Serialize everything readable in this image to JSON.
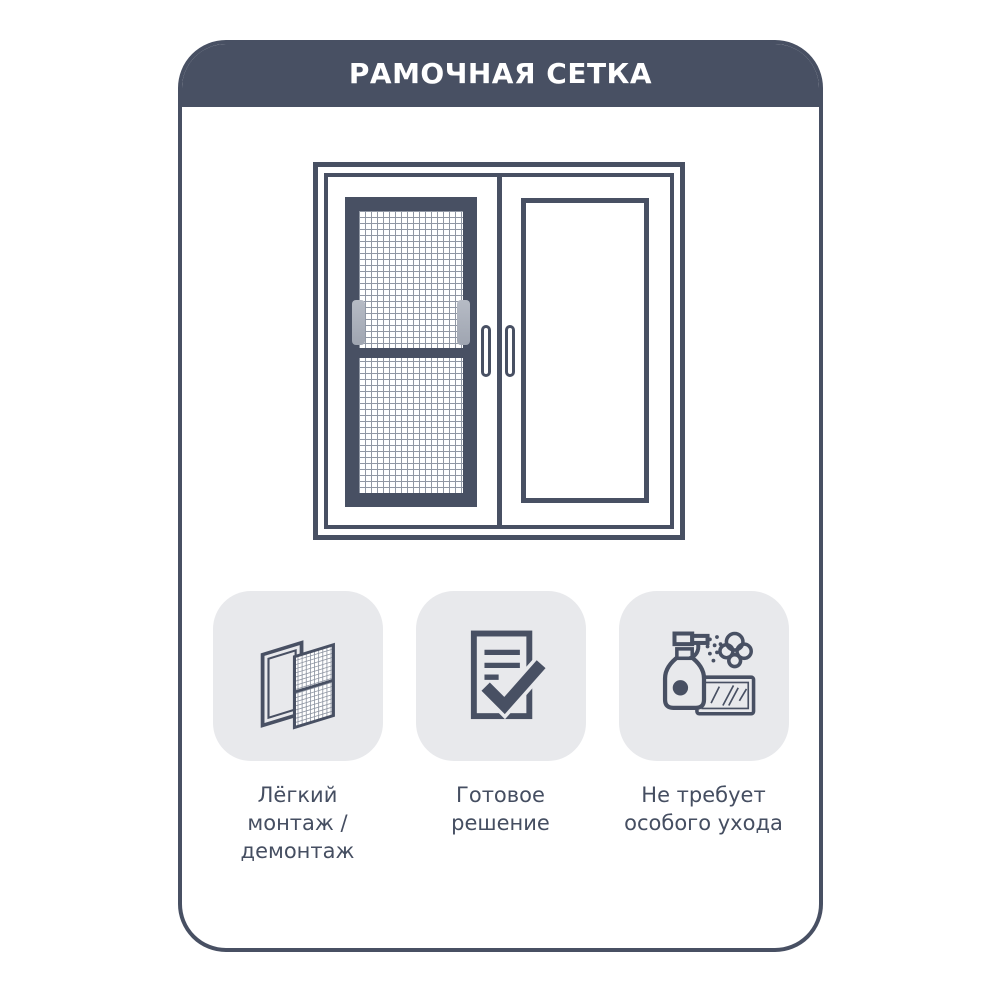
{
  "header": {
    "title": "РАМОЧНАЯ СЕТКА"
  },
  "illustration": {
    "name": "window-with-frame-mosquito-net"
  },
  "features": [
    {
      "icon": "mesh-frame-install-icon",
      "label": "Лёгкий монтаж /\nдемонтаж"
    },
    {
      "icon": "document-check-icon",
      "label": "Готовое\nрешение"
    },
    {
      "icon": "spray-easy-care-icon",
      "label": "Не требует\nособого ухода"
    }
  ],
  "colors": {
    "primary": "#485063",
    "tile_background": "#e8e9ec",
    "mesh_line": "#9097a4",
    "tab_gray": "#abb1bc",
    "page_background": "#ffffff",
    "title_text": "#ffffff",
    "caption_text": "#454e61"
  }
}
